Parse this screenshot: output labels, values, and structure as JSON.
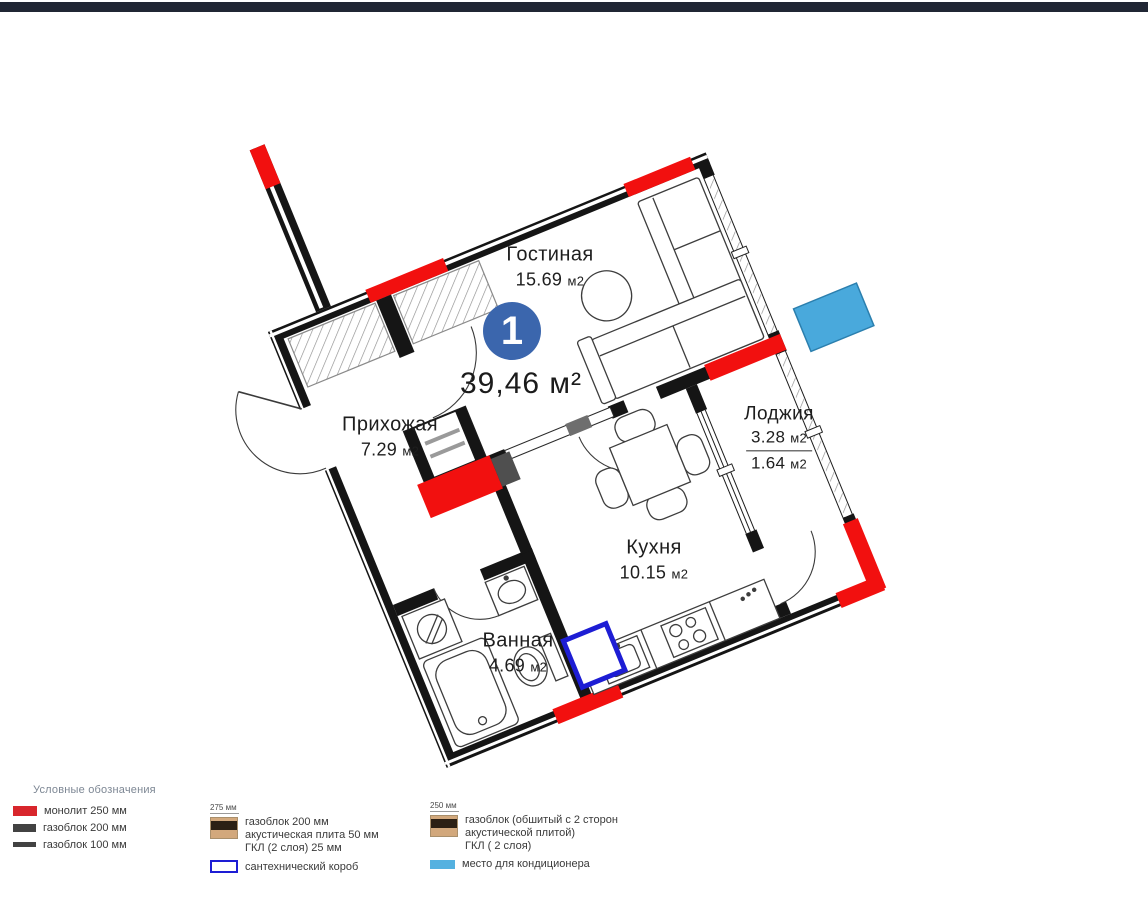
{
  "window": {
    "top_bar_color": "#202634",
    "background": "#ffffff"
  },
  "plan": {
    "unit_number": "1",
    "total_area": "39,46 м²",
    "unit_badge_color": "#3b66ad",
    "wall_color": "#151515",
    "monolith_color": "#f2100f",
    "plumbing_box_color": "#1d1dd4",
    "ac_color": "#49a9dc",
    "rooms": [
      {
        "name": "Гостиная",
        "area": "15.69",
        "unit": "м2"
      },
      {
        "name": "Прихожая",
        "area": "7.29",
        "unit": "м2"
      },
      {
        "name": "Кухня",
        "area": "10.15",
        "unit": "м2"
      },
      {
        "name": "Ванная",
        "area": "4.69",
        "unit": "м2"
      },
      {
        "name": "Лоджия",
        "area": "3.28",
        "unit": "м2",
        "area_half": "1.64",
        "unit_half": "м2"
      }
    ]
  },
  "legend": {
    "title": "Условные обозначения",
    "items_col1": [
      {
        "swatch": "monolith-red",
        "label": "монолит 250 мм"
      },
      {
        "swatch": "gasblock-200",
        "label": "газоблок 200 мм"
      },
      {
        "swatch": "gasblock-100",
        "label": "газоблок 100 мм"
      }
    ],
    "col2": {
      "dimension": "275 мм",
      "wall_lines": [
        "газоблок 200 мм",
        "акустическая плита 50 мм",
        "ГКЛ (2 слоя) 25 мм"
      ],
      "plumbing_label": "сантехнический короб"
    },
    "col3": {
      "dimension": "250 мм",
      "wall_lines": [
        "газоблок (обшитый с 2 сторон",
        "акустической плитой)",
        "ГКЛ ( 2 слоя)"
      ],
      "ac_label": "место для кондиционера"
    }
  }
}
